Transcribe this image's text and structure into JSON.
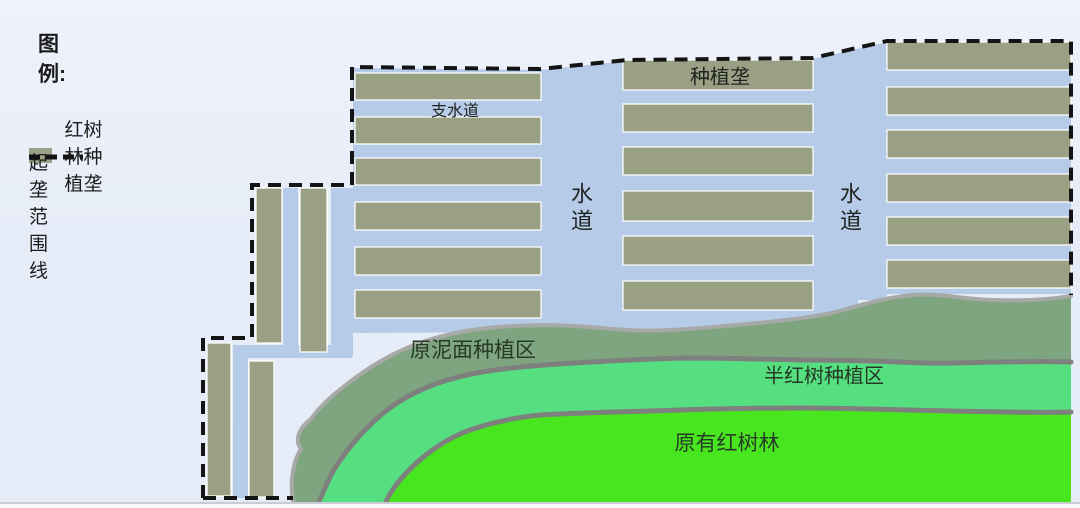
{
  "legend": {
    "title": "图例:",
    "items": [
      {
        "label": "红树林种植垄",
        "swatch": "mangrove-planting-ridge"
      },
      {
        "label": "起垄范围线",
        "swatch": "ridge-boundary-dashed-line"
      }
    ]
  },
  "labels": {
    "branch_waterway": "支水道",
    "planting_ridge": "种植垄",
    "waterway_left": "水道",
    "waterway_right": "水道",
    "mud_surface_zone": "原泥面种植区",
    "semi_mangrove_zone": "半红树种植区",
    "existing_mangrove": "原有红树林"
  },
  "colors": {
    "ridge": "#9aa083",
    "water": "#b5cbe8",
    "mud_zone": "#7ea57f",
    "semi_zone": "#55df80",
    "existing_zone": "#47e61e",
    "boundary": "#141414",
    "band_outline_light": "#a6a9a6",
    "band_outline_dark": "#7d807d",
    "background": "#e7edf8"
  }
}
